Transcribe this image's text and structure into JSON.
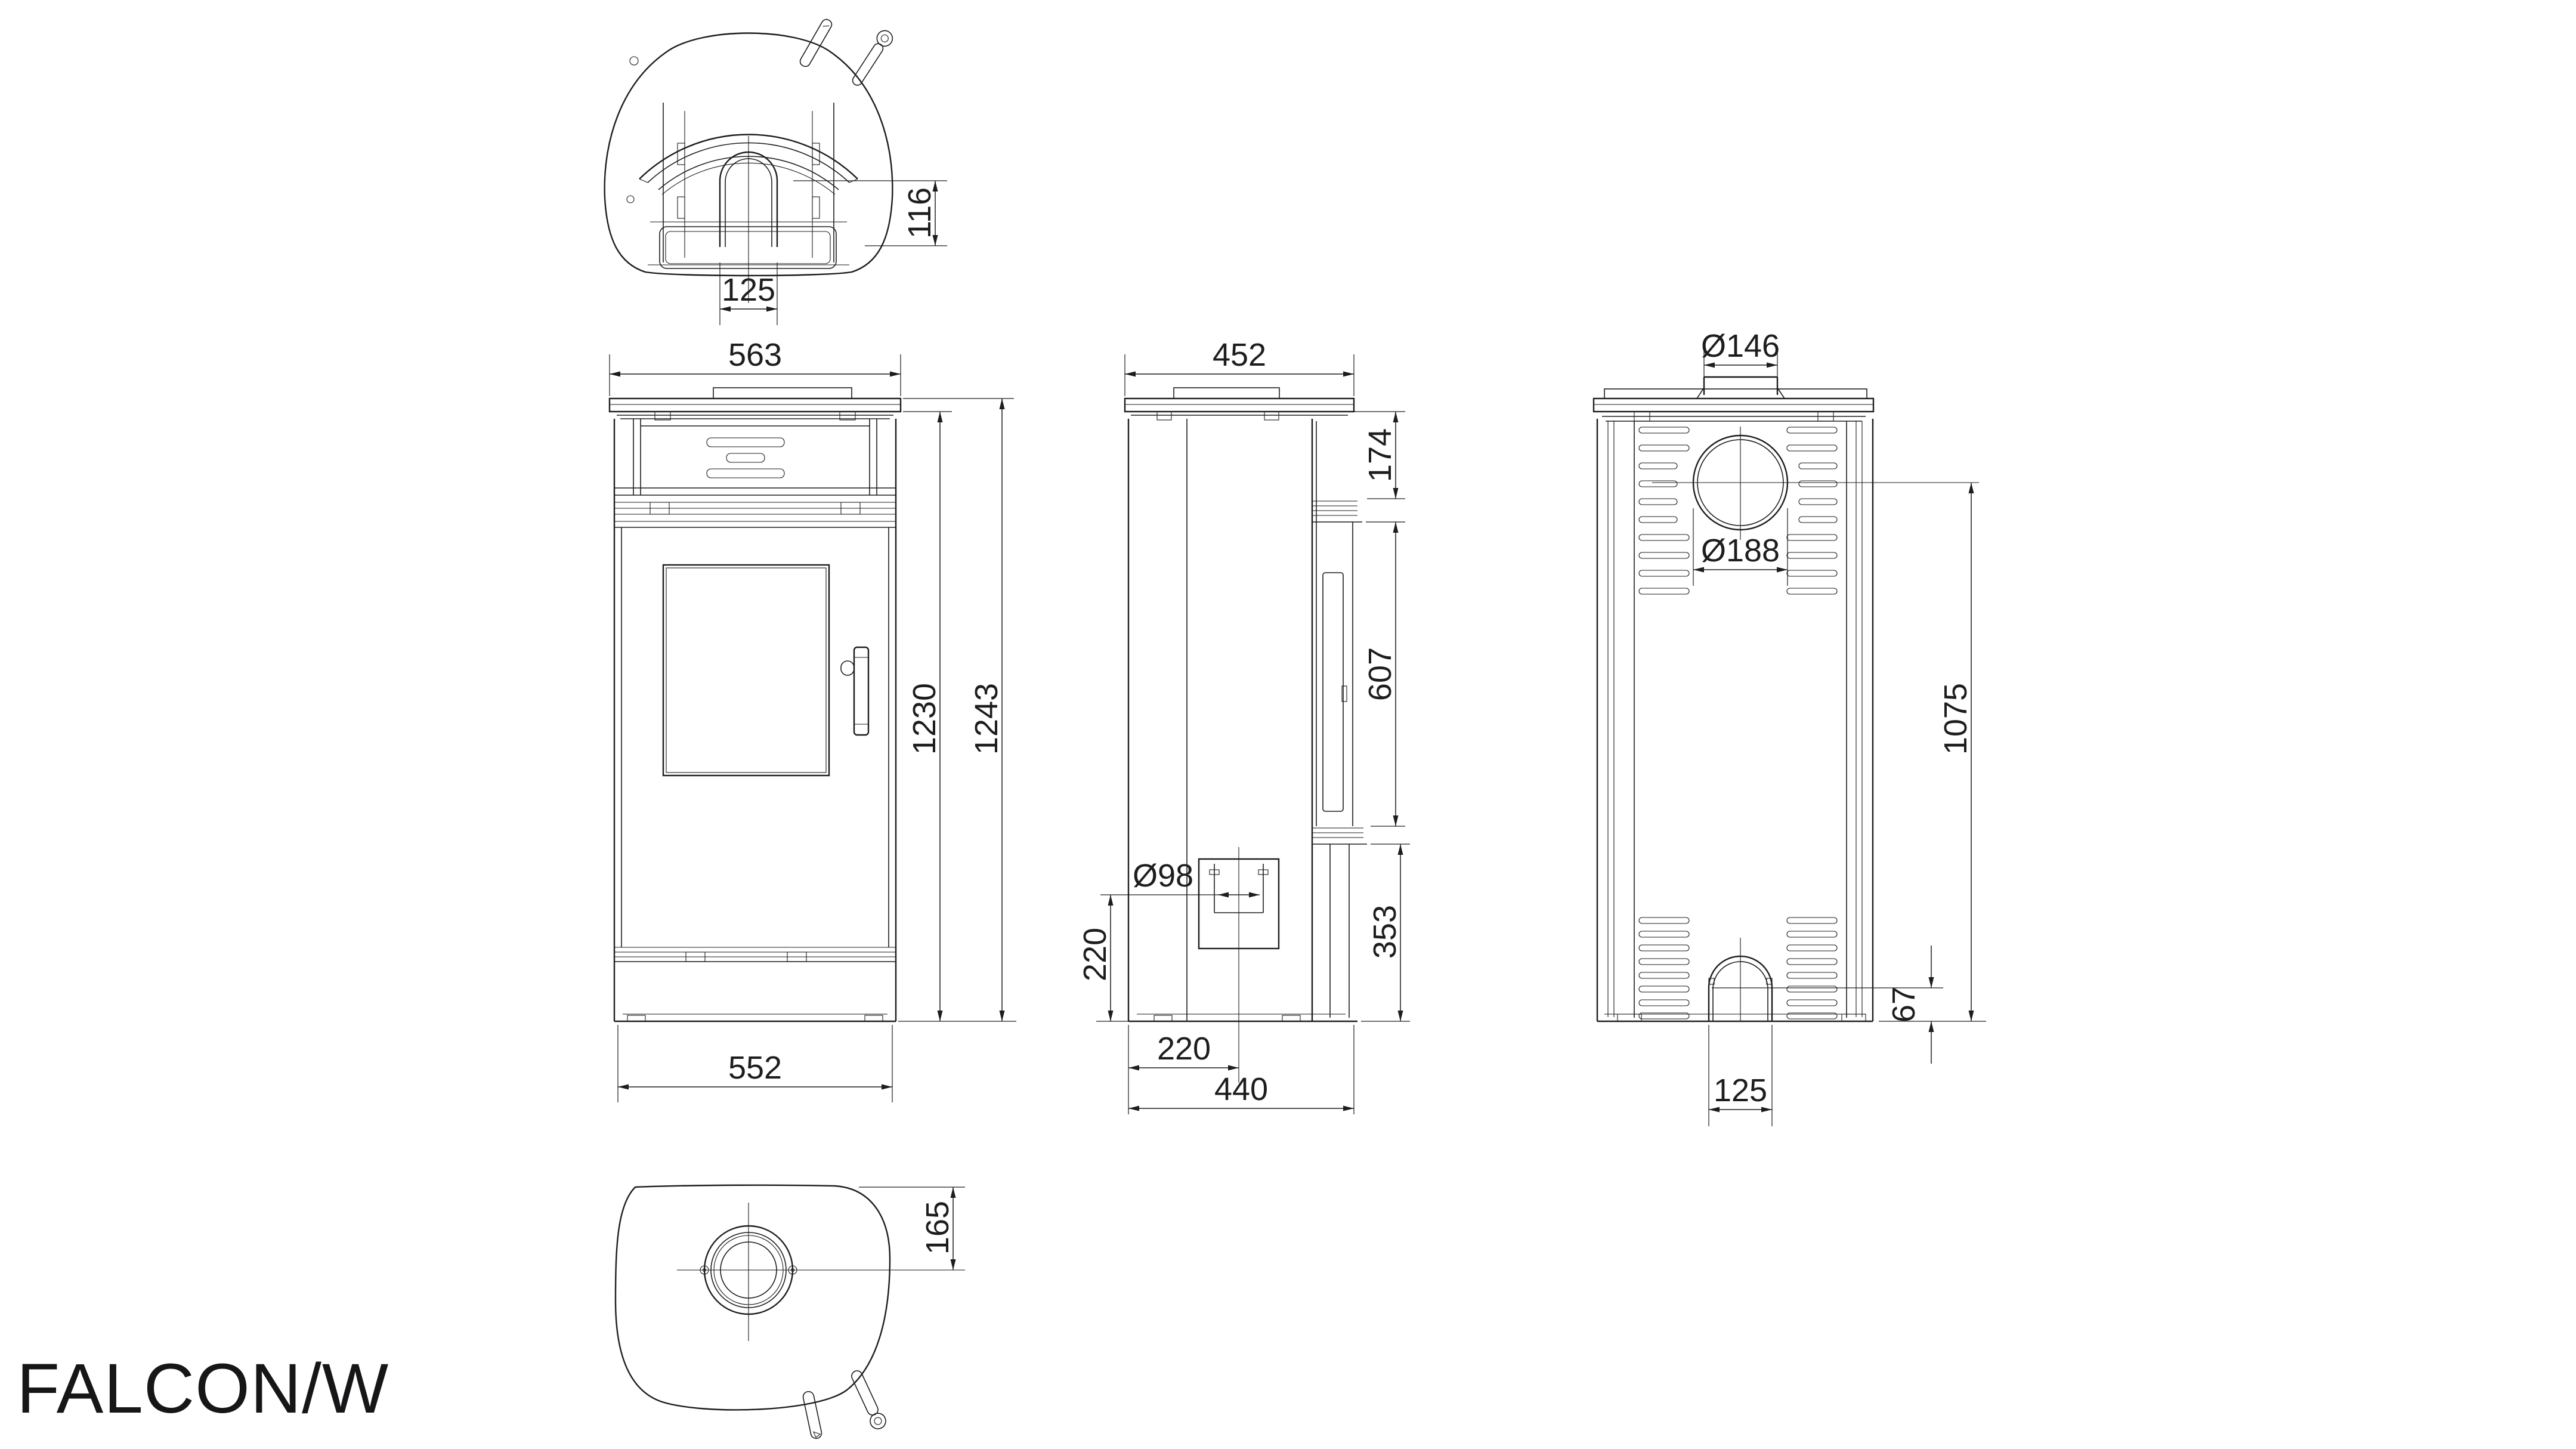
{
  "document": {
    "title": "FALCON/W"
  },
  "drawing": {
    "background": "#ffffff",
    "line_color": "#1d1d1f",
    "views": {
      "top": {
        "name": "top-section-view",
        "dims": {
          "flue_to_front": "116",
          "flue_width": "125"
        }
      },
      "front": {
        "name": "front-view",
        "dims": {
          "top_width": "563",
          "body_height": "1230",
          "total_height": "1243",
          "base_width": "552"
        }
      },
      "side": {
        "name": "side-view",
        "dims": {
          "top_depth": "452",
          "rear_upper_height": "174",
          "glass_height": "607",
          "rear_lower_height": "353",
          "inlet_diameter": "Ø98",
          "inlet_axis_height": "220",
          "inlet_setback": "220",
          "base_depth": "440"
        }
      },
      "back": {
        "name": "back-view",
        "dims": {
          "collar_diameter": "Ø146",
          "outlet_diameter": "Ø188",
          "flue_axis_height": "1075",
          "arch_height": "67",
          "arch_width": "125"
        }
      },
      "bottom": {
        "name": "bottom-view",
        "dims": {
          "flue_axis_offset": "165"
        }
      }
    }
  }
}
